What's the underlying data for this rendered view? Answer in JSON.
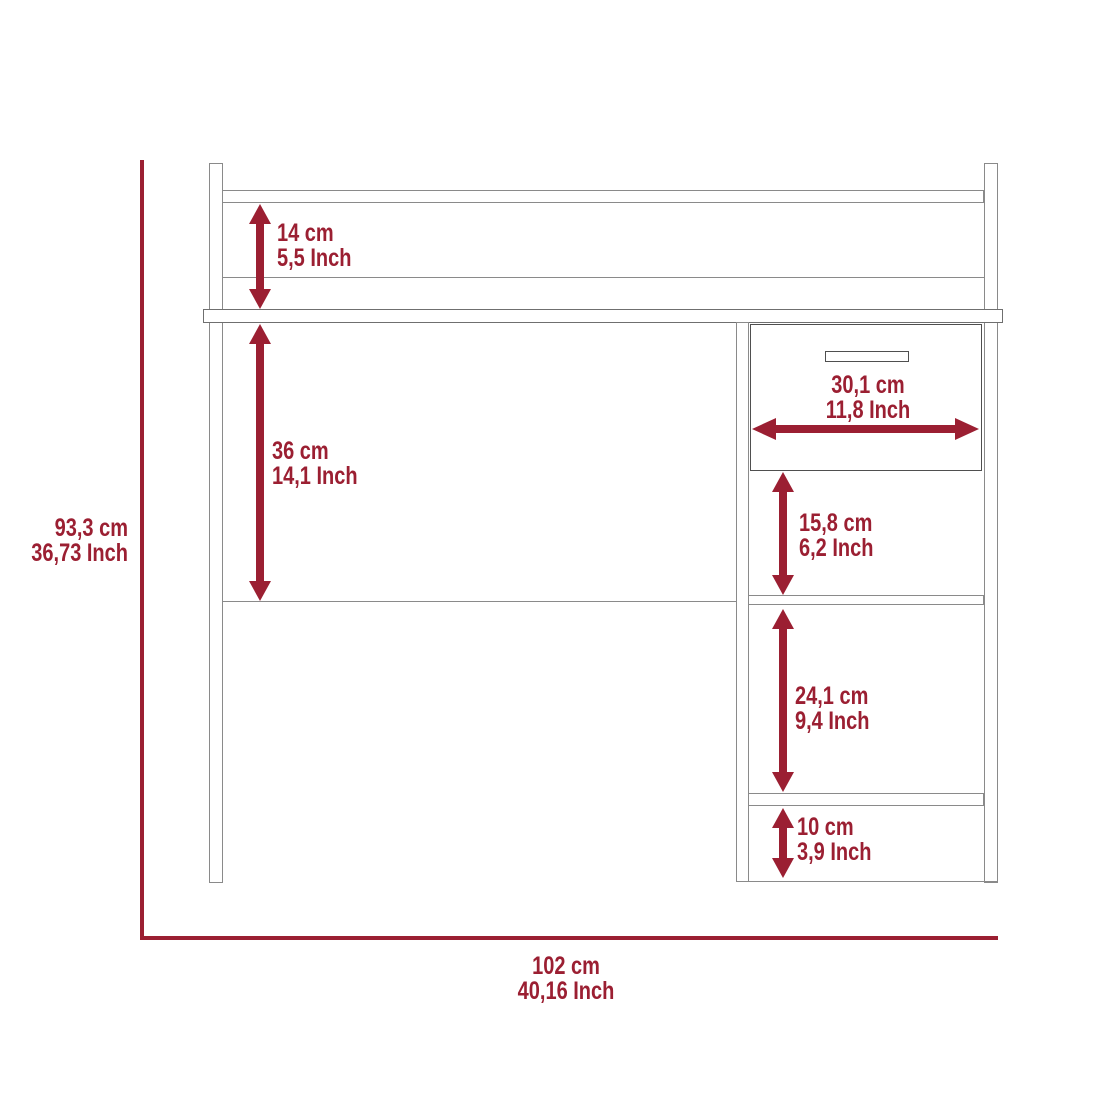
{
  "diagram": {
    "type": "furniture-dimension-diagram",
    "subject": "computer desk with hutch shelf and right drawer pedestal",
    "colors": {
      "dimension_red": "#9B1F32",
      "outline_gray": "#8a8a8a",
      "background": "#ffffff"
    },
    "overall": {
      "height": {
        "cm": "93,3 cm",
        "inch": "36,73 Inch"
      },
      "width": {
        "cm": "102 cm",
        "inch": "40,16 Inch"
      }
    },
    "dimensions": [
      {
        "id": "hutch-clearance-height",
        "cm": "14 cm",
        "inch": "5,5 Inch",
        "orientation": "vertical"
      },
      {
        "id": "desktop-to-stretcher",
        "cm": "36 cm",
        "inch": "14,1 Inch",
        "orientation": "vertical"
      },
      {
        "id": "drawer-width",
        "cm": "30,1 cm",
        "inch": "11,8 Inch",
        "orientation": "horizontal"
      },
      {
        "id": "upper-compartment-height",
        "cm": "15,8 cm",
        "inch": "6,2 Inch",
        "orientation": "vertical"
      },
      {
        "id": "middle-compartment-height",
        "cm": "24,1 cm",
        "inch": "9,4 Inch",
        "orientation": "vertical"
      },
      {
        "id": "lower-compartment-height",
        "cm": "10 cm",
        "inch": "3,9 Inch",
        "orientation": "vertical"
      }
    ]
  }
}
